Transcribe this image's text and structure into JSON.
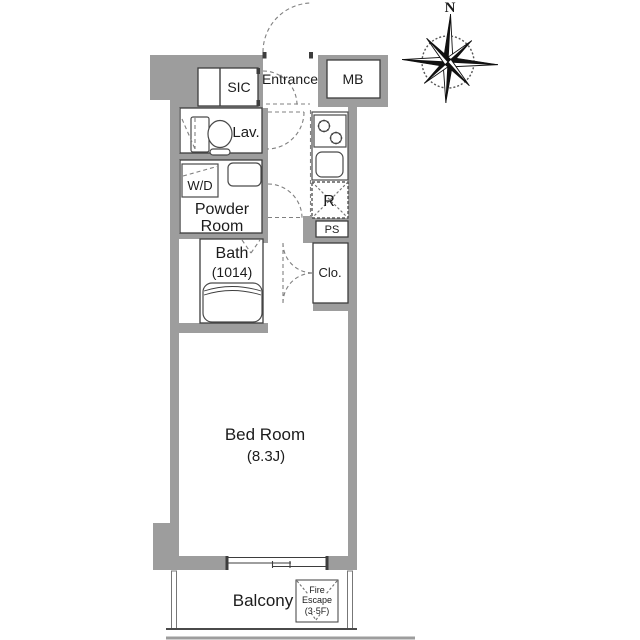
{
  "floor_plan": {
    "labels": {
      "sic": "SIC",
      "entrance": "Entrance",
      "mb": "MB",
      "lav": "Lav.",
      "wd": "W/D",
      "powder_line1": "Powder",
      "powder_line2": "Room",
      "bath": "Bath",
      "bath_size": "(1014)",
      "refrigerator": "R",
      "pipe_shaft": "PS",
      "closet": "Clo.",
      "bed_room": "Bed Room",
      "bed_room_size": "(8.3J)",
      "balcony": "Balcony",
      "fire_escape_line1": "Fire",
      "fire_escape_line2": "Escape",
      "fire_escape_line3": "(3·5F)",
      "compass_north": "N"
    },
    "colors": {
      "wall": "#9d9d9d",
      "outline": "#3d3d3d",
      "dashed": "#808080",
      "text": "#1c1c1c",
      "background": "#ffffff"
    }
  }
}
